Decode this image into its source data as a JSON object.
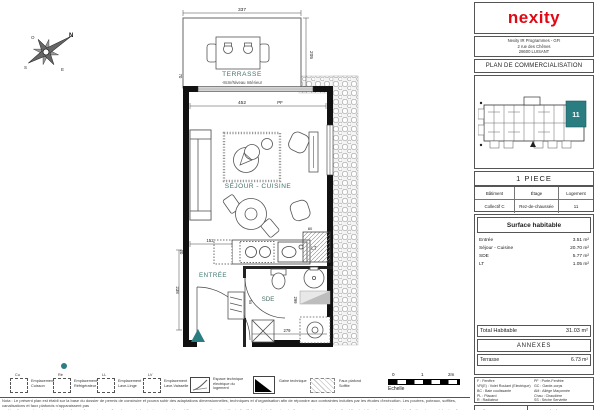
{
  "colors": {
    "accent_teal": "#2a7e82",
    "brand_red": "#e30613",
    "wall_black": "#111111"
  },
  "brand": {
    "logo_text": "nexity"
  },
  "header": {
    "address_line1": "Nexity IR Programmes - GFI",
    "address_line2": "2 rue des Chênes",
    "address_line3": "28600 LUISANT",
    "doc_title": "PLAN DE COMMERCIALISATION"
  },
  "site_plan": {
    "unit_label": "11"
  },
  "unit": {
    "type_title": "1 PIECE",
    "table_headers": [
      "Bâtiment",
      "Étage",
      "Logement"
    ],
    "table_values": [
      "Collectif C",
      "Rez-de-chaussée",
      "11"
    ]
  },
  "surfaces": {
    "title": "Surface habitable",
    "rows": [
      {
        "label": "Entrée",
        "value": "3.51 m²"
      },
      {
        "label": "Séjour - Cuisine",
        "value": "20.70 m²"
      },
      {
        "label": "SDE",
        "value": "5.77 m²"
      },
      {
        "label": "LT",
        "value": "1.05 m²"
      }
    ],
    "total_label": "Total Habitable",
    "total_value": "31.03 m²",
    "annexes_title": "ANNEXES",
    "annex_label": "Terrasse",
    "annex_value": "6.73 m²"
  },
  "abbrev_legend": {
    "left": [
      "F : Fenêtre",
      "VR(E) : Volet Roulant (Electrique)",
      "BC : Baie coulissante",
      "PL : Placard",
      "R : Radiateur"
    ],
    "right": [
      "PF : Porte-Fenêtre",
      "GC : Garde-corps",
      "AM : Allège Maçonnée",
      "Chau : Chaudière",
      "SS : Sèche Serviette"
    ]
  },
  "meta": {
    "indice": "Indice : B",
    "date": "Date : 11/09/2024"
  },
  "plan": {
    "compass": {
      "n": "N",
      "s": "S",
      "e": "E",
      "o": "O"
    },
    "rooms": {
      "terrasse": "TERRASSE",
      "terrasse_note": "-8cm/Niveau Intérieur",
      "sejour": "SÉJOUR - CUISINE",
      "entree": "ENTRÉE",
      "sde": "SDE",
      "lt": "LT"
    },
    "dims": {
      "d337": "337",
      "d205": "205",
      "d70": "70",
      "d452": "452",
      "pf": "PF",
      "d152": "152",
      "d238": "238",
      "d20": "20",
      "d95": "95",
      "d80": "80",
      "d124": "124",
      "d299": "299",
      "d279": "279"
    }
  },
  "bottom_legend": {
    "items": [
      {
        "tag": "Cu",
        "label": "Emplacement Cuisson"
      },
      {
        "tag": "Ré",
        "label": "Emplacement Réfrigérateur"
      },
      {
        "tag": "LL",
        "label": "Emplacement Lave-Linge"
      },
      {
        "tag": "LV",
        "label": "Emplacement Lave-Vaisselle"
      },
      {
        "tag": "",
        "label": "Espace technique électrique du logement"
      },
      {
        "tag": "",
        "label": "Gaine technique"
      },
      {
        "tag": "",
        "label": "Faux plafond Soffite"
      }
    ]
  },
  "scale": {
    "t0": "0",
    "t1": "1",
    "t2": "2m",
    "label": "Echelle"
  },
  "disclaimer": {
    "line1": "Nota : Le présent plan est établi sur la base du dossier de permis de construire et pourra subir des adaptations dimensionnelles, techniques et d'organisation afin de répondre aux contraintes induites par les études d'exécution. Les poutres, poteaux, soffites, canalisations et faux plafonds n'apparaissent pas",
    "line2": "systématiquement sur le présent plan. Les surfaces ainsi que l'emplacement des équipements et le mobilier sont mentionnés à titre indicatif. Les plantations éventuelles ne sont pas contractuelles. L'implantation des meubles est indicative et permet de visualiser les possibilités d'aménagement."
  }
}
